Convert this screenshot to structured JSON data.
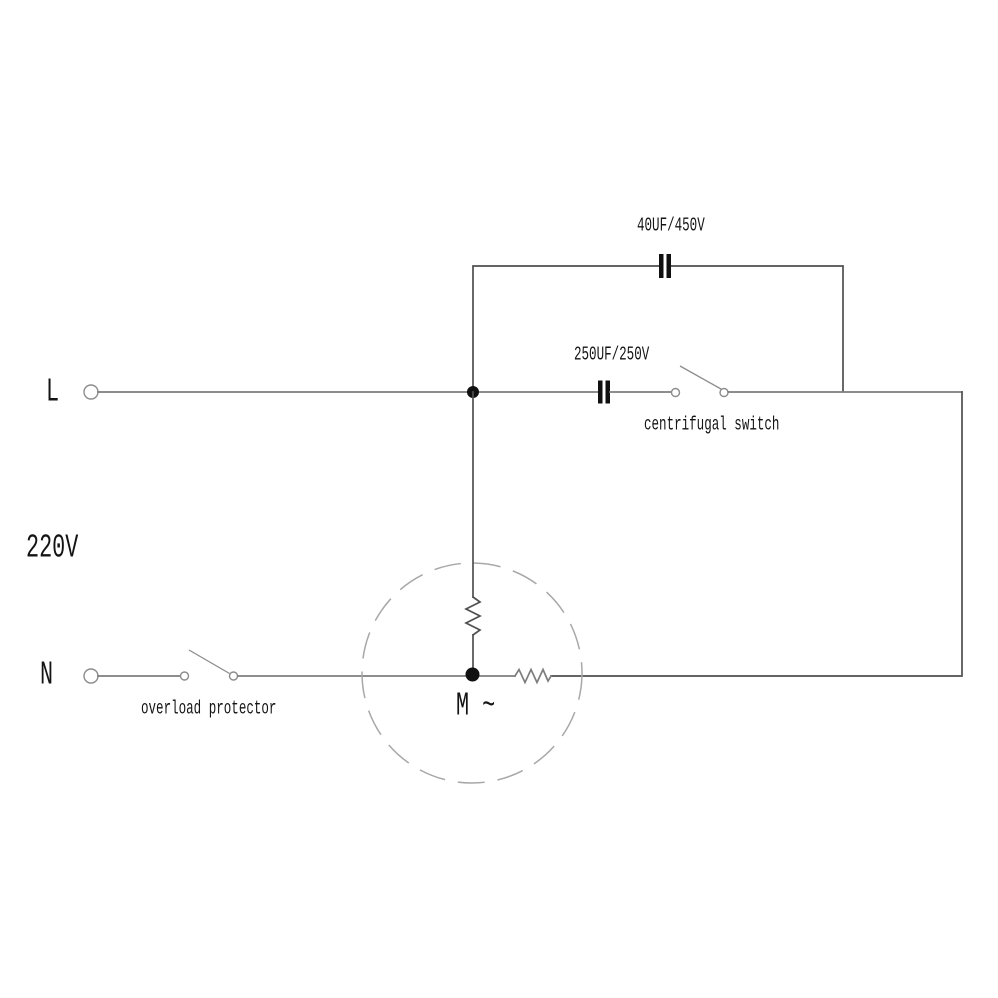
{
  "labels": {
    "line_terminal": "L",
    "neutral_terminal": "N",
    "supply_voltage": "220V",
    "run_capacitor": "40UF/450V",
    "start_capacitor": "250UF/250V",
    "centrifugal_switch": "centrifugal switch",
    "overload_protector": "overload protector",
    "motor": "M ~"
  },
  "colors": {
    "background": "#ffffff",
    "wire": "#4f4f4f",
    "wire_light": "#7d7d7d",
    "contact": "#8c8c8c",
    "symbol": "#101010",
    "motor_outline": "#a8a8a8",
    "text": "#141414"
  }
}
